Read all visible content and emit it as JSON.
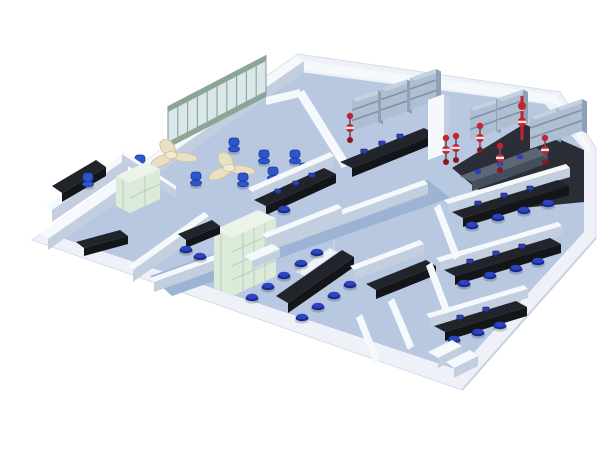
{
  "image": {
    "kind": "3D isometric rendering of a laboratory floor plan",
    "background": "#ffffff",
    "no_visible_text": true
  },
  "palette": {
    "bg": "#ffffff",
    "slabTop": "#eef2f8",
    "slabEdge": "#d5dde9",
    "floorMain": "#b7c8e0",
    "floorCorridor": "#9db3d4",
    "labFloorDark": "#2b2e36",
    "wallFace": "#f6f9fc",
    "wallSide": "#c3cfdf",
    "benchTop": "#22242c",
    "benchFace": "#131519",
    "steelBench": "#5c6675",
    "deskCream": "#eadfc2",
    "deskEdge": "#cfc09a",
    "glassFrame": "#8ba596",
    "glassPane": "#d9e7ea",
    "greenCab": "#dcead9",
    "greenCabFrame": "#b9d0bb",
    "greenCabLight": "#ecf4e9",
    "shelfSteel": "#aebfd2",
    "shelfDark": "#8ea1b9",
    "shelfLine": "#7e92ac",
    "stool": "#2c43c4",
    "stoolDark": "#1a2a88",
    "chairBlue": "#2d55cc",
    "blueItem": "#2b3fc0",
    "red": "#c5232e",
    "redDark": "#8e1620",
    "reagentWhite": "#eff3f8"
  },
  "areas": [
    {
      "id": "open-office",
      "label": "Open office: 2 pinwheel cluster desks, blue task chairs, glass partition wall"
    },
    {
      "id": "left-wing-offices",
      "label": "Small offices with dark corner counters"
    },
    {
      "id": "central-lab",
      "label": "Central lab: green sample cabinets, island bench with reagent shelf and blue stools"
    },
    {
      "id": "instrument-lab",
      "label": "Instrument lab: steel wall shelving, black-top bench, emergency shower"
    },
    {
      "id": "chemistry-lab",
      "label": "Chemistry lab: reagent shelving banks, dark floor, red eyewash/shower stations"
    },
    {
      "id": "right-wing-labs",
      "label": "Three bench rooms with blue stools"
    }
  ],
  "inventory": {
    "pinwheel_desks": 2,
    "office_chairs": 9,
    "lab_stools": 23,
    "glass_partition_panels": 10,
    "green_cabinet_banks": 2,
    "wall_shelving_units": 7,
    "red_emergency_stations": 7,
    "dark_top_benches": 9
  }
}
